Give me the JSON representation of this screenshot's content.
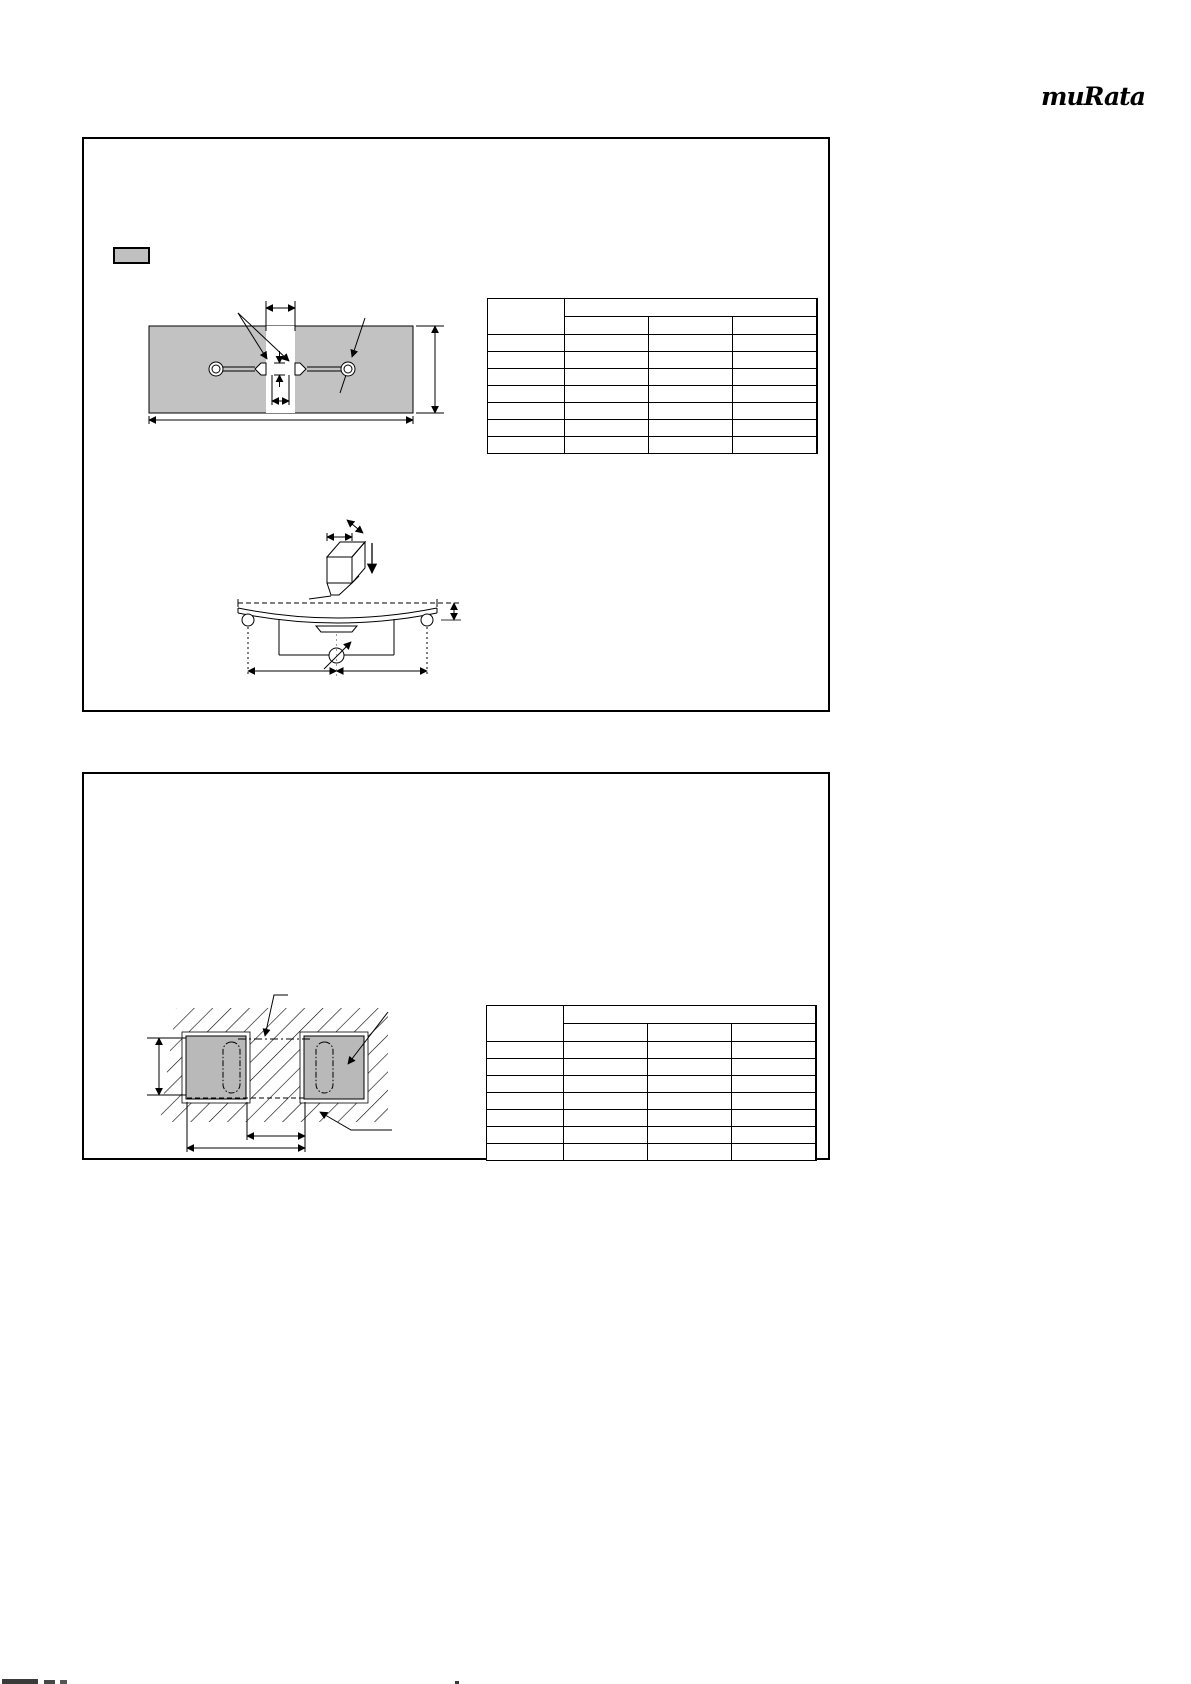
{
  "page": {
    "width": 1191,
    "height": 1684,
    "background": "#ffffff"
  },
  "logo": {
    "text": "muRata",
    "color": "#000000"
  },
  "colors": {
    "line": "#000000",
    "board_fill": "#c2c2c2",
    "chip_fill": "#b9b9b9",
    "swatch_fill": "#c0c0c0",
    "gray_guide": "#9a9a9a"
  },
  "panels": [
    {
      "id": "panel-1",
      "contents": [
        "legend-swatch",
        "land-pattern-diagram",
        "spec-table",
        "substrate-bending-diagram"
      ],
      "legend_swatch": {
        "fill": "#c0c0c0",
        "border": "#000000",
        "label": ""
      },
      "table": {
        "columns": 4,
        "column_widths_px": [
          77,
          84,
          84,
          84
        ],
        "header": {
          "corner_cell": "",
          "group_cell_colspan3": "",
          "sub_cells": [
            "",
            "",
            ""
          ]
        },
        "data_rows": [
          [
            "",
            "",
            "",
            ""
          ],
          [
            "",
            "",
            "",
            ""
          ],
          [
            "",
            "",
            "",
            ""
          ],
          [
            "",
            "",
            "",
            ""
          ],
          [
            "",
            "",
            "",
            ""
          ],
          [
            "",
            "",
            "",
            ""
          ],
          [
            "",
            "",
            "",
            ""
          ]
        ]
      }
    },
    {
      "id": "panel-2",
      "contents": [
        "embedded-chips-diagram",
        "spec-table"
      ],
      "table": {
        "columns": 4,
        "column_widths_px": [
          77,
          84,
          84,
          84
        ],
        "header": {
          "corner_cell": "",
          "group_cell_colspan3": "",
          "sub_cells": [
            "",
            "",
            ""
          ]
        },
        "data_rows": [
          [
            "",
            "",
            "",
            ""
          ],
          [
            "",
            "",
            "",
            ""
          ],
          [
            "",
            "",
            "",
            ""
          ],
          [
            "",
            "",
            "",
            ""
          ],
          [
            "",
            "",
            "",
            ""
          ],
          [
            "",
            "",
            "",
            ""
          ],
          [
            "",
            "",
            "",
            ""
          ]
        ]
      }
    }
  ],
  "diagrams": {
    "land_pattern": {
      "board_fill": "#c2c2c2",
      "elements": [
        "board",
        "resist-slit",
        "left-eyelet",
        "right-eyelet",
        "traces",
        "left-land",
        "right-land",
        "slit-width-dimension",
        "land-dimensions",
        "board-height-dimension",
        "board-width-dimension",
        "leader-lines"
      ]
    },
    "substrate_bending": {
      "elements": [
        "pressurizing-jig",
        "jig-dimensions",
        "force-arrow",
        "initial-position-dashed-line",
        "bent-substrate",
        "chip",
        "support-rollers",
        "measuring-circuit",
        "meter-symbol",
        "deflection-dimension",
        "span-dimensions"
      ]
    },
    "embedded_chips": {
      "hatch": true,
      "chip_fill": "#b9b9b9",
      "elements": [
        "hatched-resin-area",
        "left-chip",
        "right-chip",
        "inner-electrode-outlines",
        "center-dash-dot-line",
        "bottom-dashed-line",
        "chip-height-dimension",
        "gap-dimension",
        "pitch-dimension",
        "leader-arrows"
      ]
    }
  },
  "footer": {
    "clipped_text_fragments": true
  }
}
